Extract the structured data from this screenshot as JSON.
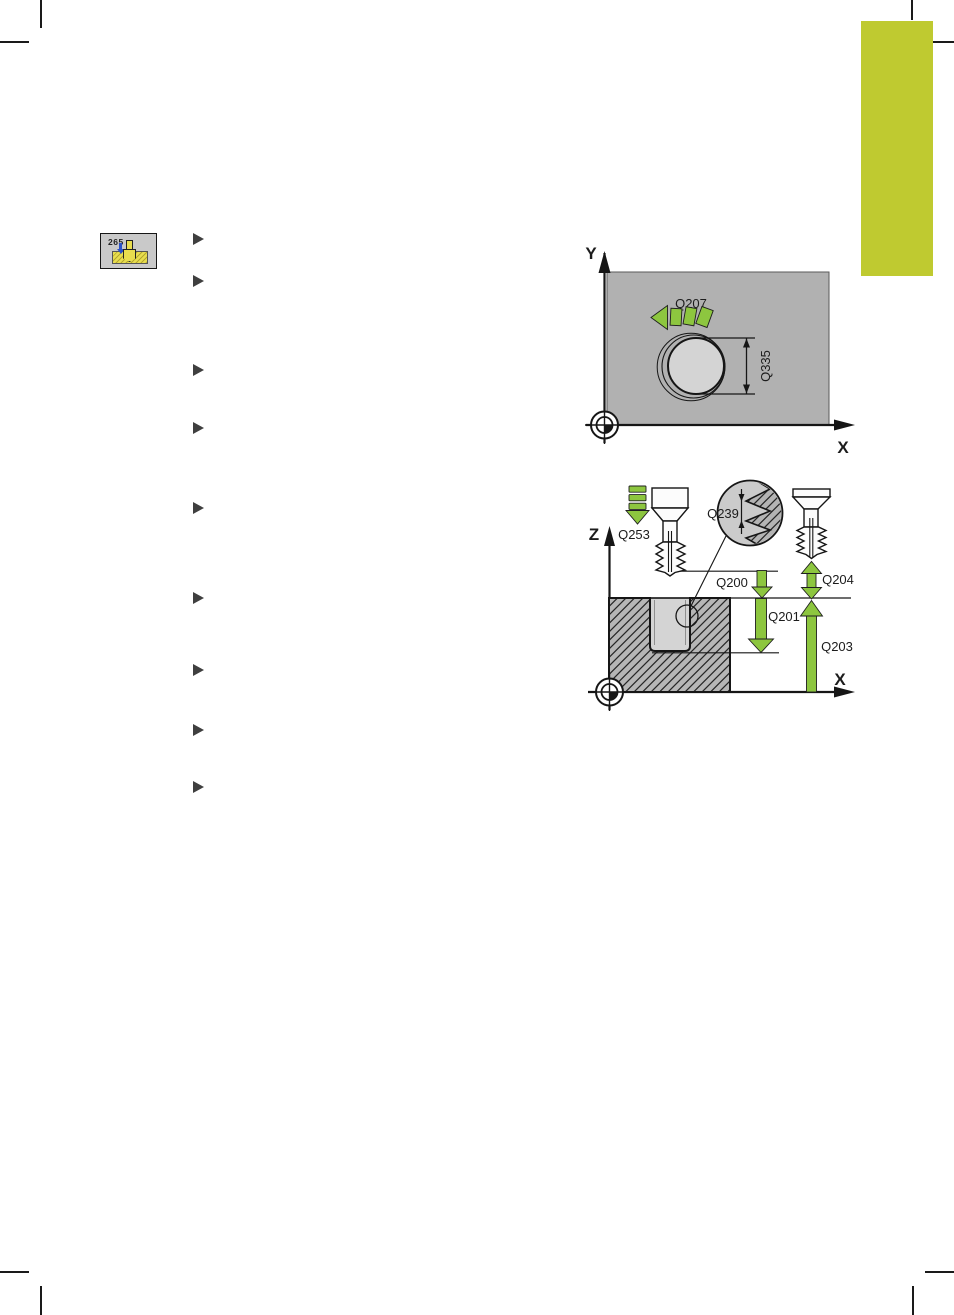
{
  "document": {
    "kind": "cnc-manual-page",
    "cycle_softkey": {
      "cycle_number": "265",
      "icon": "thread-drilling-milling-cycle-icon"
    },
    "bullet_list": {
      "count": 9,
      "marker": "right-triangle"
    }
  },
  "colors": {
    "sidebar": "#bfca30",
    "green": "#8dc63f",
    "workpiece_gray": "#b1b1b1",
    "hole_gray": "#d4d4d4",
    "detail_gray": "#cbcbcb",
    "hatch_gray": "#b6b6b6",
    "softkey_gray": "#c9c9c9",
    "softkey_yellow": "#e8dd4e",
    "ink": "#161616"
  },
  "diagram_top": {
    "name": "plan-view-xy",
    "axis": {
      "x": "X",
      "y": "Y"
    },
    "labels": {
      "q207": "Q207",
      "q335": "Q335"
    }
  },
  "diagram_bottom": {
    "name": "section-view-zx",
    "axis": {
      "x": "X",
      "z": "Z"
    },
    "labels": {
      "q253": "Q253",
      "q239": "Q239",
      "q200": "Q200",
      "q201": "Q201",
      "q203": "Q203",
      "q204": "Q204"
    }
  }
}
